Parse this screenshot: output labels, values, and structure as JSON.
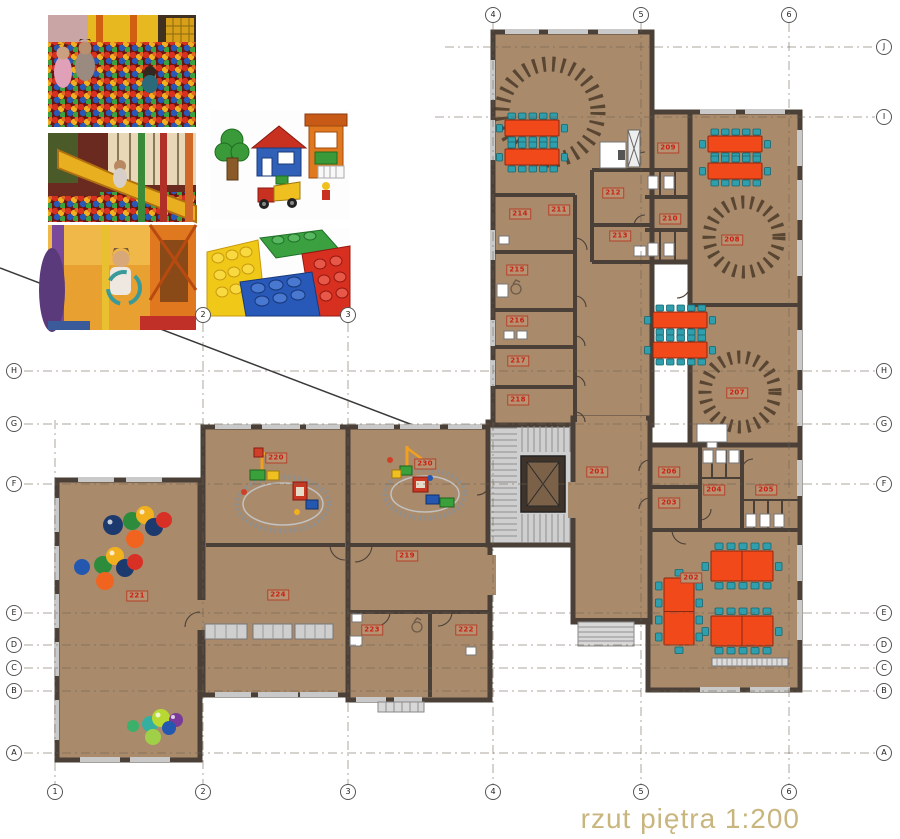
{
  "caption": {
    "text": "rzut piętra  1:200"
  },
  "palette": {
    "floor": "#a98a6b",
    "wall": "#4a4038",
    "window": "#c9c9c9",
    "table": "#f2491b",
    "chair": "#2f9fae",
    "label": "#cc2012",
    "rug": "#4a3828",
    "grid": "#6b5d4e",
    "caption": "#c9b67f",
    "ballred": "#d93025",
    "ballblue": "#2458b0",
    "ballnavy": "#1d3a6e",
    "ballgreen": "#2c8c3c",
    "ballyellow": "#f2b01e",
    "ballorange": "#f06420"
  },
  "plan": {
    "scale": "1:200",
    "rooms": [
      {
        "number": "201",
        "x": 597,
        "y": 472
      },
      {
        "number": "202",
        "x": 691,
        "y": 578
      },
      {
        "number": "203",
        "x": 669,
        "y": 503
      },
      {
        "number": "204",
        "x": 714,
        "y": 490
      },
      {
        "number": "205",
        "x": 766,
        "y": 490
      },
      {
        "number": "206",
        "x": 669,
        "y": 472
      },
      {
        "number": "207",
        "x": 737,
        "y": 393
      },
      {
        "number": "208",
        "x": 732,
        "y": 240
      },
      {
        "number": "209",
        "x": 668,
        "y": 148
      },
      {
        "number": "210",
        "x": 670,
        "y": 219
      },
      {
        "number": "211",
        "x": 559,
        "y": 210
      },
      {
        "number": "212",
        "x": 613,
        "y": 193
      },
      {
        "number": "213",
        "x": 620,
        "y": 236
      },
      {
        "number": "214",
        "x": 520,
        "y": 214
      },
      {
        "number": "215",
        "x": 517,
        "y": 270
      },
      {
        "number": "216",
        "x": 517,
        "y": 321
      },
      {
        "number": "217",
        "x": 518,
        "y": 361
      },
      {
        "number": "218",
        "x": 518,
        "y": 400
      },
      {
        "number": "219",
        "x": 407,
        "y": 556
      },
      {
        "number": "220",
        "x": 276,
        "y": 458
      },
      {
        "number": "230",
        "x": 425,
        "y": 464
      },
      {
        "number": "221",
        "x": 137,
        "y": 596
      },
      {
        "number": "224",
        "x": 278,
        "y": 595
      },
      {
        "number": "223",
        "x": 372,
        "y": 630
      },
      {
        "number": "222",
        "x": 466,
        "y": 630
      }
    ],
    "grid_markers": [
      {
        "label": "4",
        "x": 493,
        "y": 15
      },
      {
        "label": "5",
        "x": 641,
        "y": 15
      },
      {
        "label": "6",
        "x": 789,
        "y": 15
      },
      {
        "label": "2",
        "x": 203,
        "y": 315
      },
      {
        "label": "3",
        "x": 348,
        "y": 315
      },
      {
        "label": "1",
        "x": 55,
        "y": 792
      },
      {
        "label": "2",
        "x": 203,
        "y": 792
      },
      {
        "label": "3",
        "x": 348,
        "y": 792
      },
      {
        "label": "4",
        "x": 493,
        "y": 792
      },
      {
        "label": "5",
        "x": 641,
        "y": 792
      },
      {
        "label": "6",
        "x": 789,
        "y": 792
      },
      {
        "label": "H",
        "x": 14,
        "y": 371
      },
      {
        "label": "G",
        "x": 14,
        "y": 424
      },
      {
        "label": "F",
        "x": 14,
        "y": 484
      },
      {
        "label": "E",
        "x": 14,
        "y": 613
      },
      {
        "label": "D",
        "x": 14,
        "y": 645
      },
      {
        "label": "C",
        "x": 14,
        "y": 668
      },
      {
        "label": "B",
        "x": 14,
        "y": 691
      },
      {
        "label": "A",
        "x": 14,
        "y": 753
      },
      {
        "label": "J",
        "x": 884,
        "y": 47
      },
      {
        "label": "I",
        "x": 884,
        "y": 117
      },
      {
        "label": "H",
        "x": 884,
        "y": 371
      },
      {
        "label": "G",
        "x": 884,
        "y": 424
      },
      {
        "label": "F",
        "x": 884,
        "y": 484
      },
      {
        "label": "E",
        "x": 884,
        "y": 613
      },
      {
        "label": "D",
        "x": 884,
        "y": 645
      },
      {
        "label": "C",
        "x": 884,
        "y": 668
      },
      {
        "label": "B",
        "x": 884,
        "y": 691
      },
      {
        "label": "A",
        "x": 884,
        "y": 753
      }
    ]
  },
  "photos": [
    {
      "name": "ball-pit-children-photo"
    },
    {
      "name": "slide-ball-pool-photo"
    },
    {
      "name": "play-structure-child-photo"
    },
    {
      "name": "duplo-blocks-set-photo"
    },
    {
      "name": "large-building-blocks-photo"
    }
  ]
}
